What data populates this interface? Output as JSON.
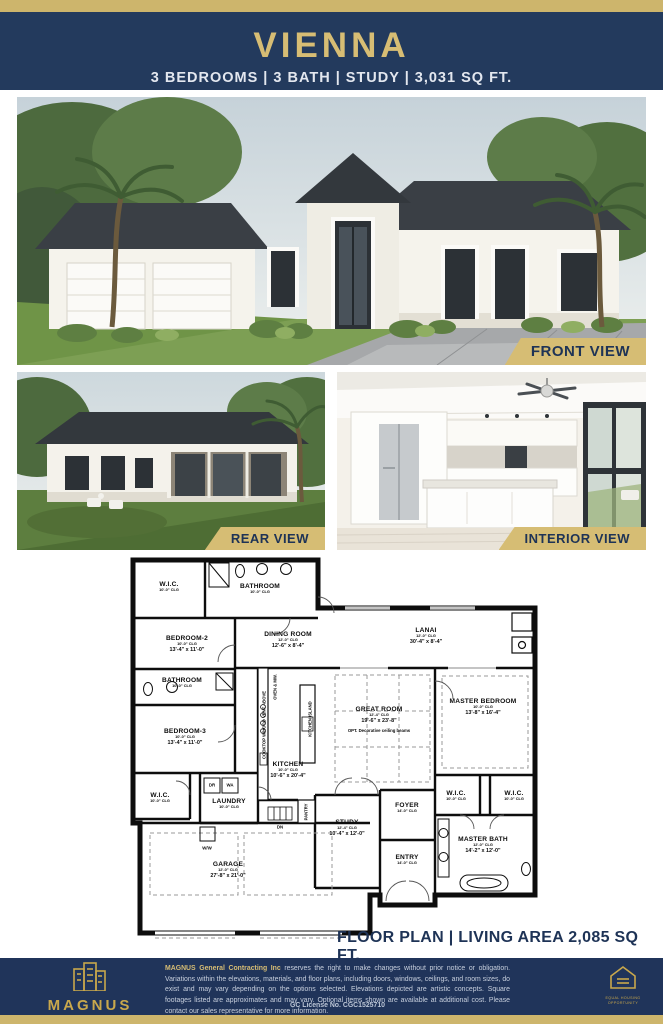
{
  "colors": {
    "gold": "#cdb56c",
    "banner_gold": "#d6bd74",
    "navy": "#233a5d",
    "footer_navy": "#20345a",
    "text_navy": "#1e3356"
  },
  "header": {
    "title": "VIENNA",
    "subtitle": "3 BEDROOMS | 3 BATH | STUDY | 3,031 SQ FT."
  },
  "views": {
    "front_label": "FRONT VIEW",
    "rear_label": "REAR VIEW",
    "interior_label": "INTERIOR VIEW"
  },
  "floor_plan": {
    "caption": "FLOOR PLAN  |  LIVING AREA 2,085 SQ FT.",
    "rooms": [
      {
        "name": "W.I.C.",
        "clg": "10'-0\" CLG",
        "x": 39,
        "y": 30
      },
      {
        "name": "BATHROOM",
        "clg": "10'-0\" CLG",
        "x": 130,
        "y": 32
      },
      {
        "name": "BEDROOM-2",
        "clg": "10'-0\" CLG",
        "dims": "13'-4\" x 11'-0\"",
        "x": 57,
        "y": 87
      },
      {
        "name": "DINING ROOM",
        "clg": "12'-0\" CLG",
        "dims": "12'-6\" x 8'-4\"",
        "x": 158,
        "y": 83
      },
      {
        "name": "LANAI",
        "clg": "12'-0\" CLG",
        "dims": "30'-4\" x 8'-4\"",
        "x": 296,
        "y": 79
      },
      {
        "name": "BATHROOM",
        "clg": "10'-0\" CLG",
        "x": 52,
        "y": 126
      },
      {
        "name": "BEDROOM-3",
        "clg": "10'-0\" CLG",
        "dims": "13'-4\" x 11'-0\"",
        "x": 55,
        "y": 180
      },
      {
        "name": "W.I.C.",
        "clg": "10'-0\" CLG",
        "x": 30,
        "y": 241
      },
      {
        "name": "LAUNDRY",
        "clg": "10'-0\" CLG",
        "x": 99,
        "y": 247
      },
      {
        "name": "KITCHEN",
        "clg": "10'-0\" CLG",
        "dims": "10'-6\" x 20'-4\"",
        "x": 158,
        "y": 213
      },
      {
        "name": "GREAT ROOM",
        "clg": "12'-4\" CLG",
        "dims": "19'-6\" x 23'-8\"",
        "note": "OPT. Decorative ceiling beams",
        "x": 249,
        "y": 163
      },
      {
        "name": "MASTER BEDROOM",
        "clg": "10'-0\" CLG",
        "dims": "13'-8\" x 16'-4\"",
        "x": 353,
        "y": 150
      },
      {
        "name": "W.I.C.",
        "clg": "10'-0\" CLG",
        "x": 326,
        "y": 239
      },
      {
        "name": "W.I.C.",
        "clg": "10'-0\" CLG",
        "x": 384,
        "y": 239
      },
      {
        "name": "FOYER",
        "clg": "14'-0\" CLG",
        "x": 277,
        "y": 251
      },
      {
        "name": "STUDY",
        "clg": "12'-4\" CLG",
        "dims": "10'-4\" x 12'-0\"",
        "x": 217,
        "y": 271
      },
      {
        "name": "ENTRY",
        "clg": "14'-0\" CLG",
        "x": 277,
        "y": 303
      },
      {
        "name": "MASTER BATH",
        "clg": "12'-0\" CLG",
        "dims": "14'-2\" x 12'-0\"",
        "x": 353,
        "y": 288
      },
      {
        "name": "GARAGE",
        "clg": "12'-0\" CLG",
        "dims": "27'-8\" x 21'-0\"",
        "x": 98,
        "y": 313
      }
    ],
    "vertical_labels": [
      {
        "text": "OVEN & MW.",
        "x": 145,
        "y": 130
      },
      {
        "text": "COOKTOP W/HOOD VENT ABOVE",
        "x": 134,
        "y": 168
      },
      {
        "text": "KITCHEN ISLAND",
        "x": 180,
        "y": 162
      },
      {
        "text": "PANTRY",
        "x": 176,
        "y": 255
      }
    ],
    "small_labels": [
      {
        "text": "DR",
        "x": 82,
        "y": 228
      },
      {
        "text": "WA",
        "x": 100,
        "y": 228
      },
      {
        "text": "DN",
        "x": 150,
        "y": 270
      },
      {
        "text": "W/W",
        "x": 77,
        "y": 291
      }
    ]
  },
  "footer": {
    "brand": "MAGNUS",
    "brand_sub": "GENERAL CONTRACTING INC",
    "disclaimer_lead": "MAGNUS General Contracting Inc",
    "disclaimer_body": " reserves the right to make changes without prior notice or obligation.  Variations within the elevations, materials, and floor plans, including doors, windows, ceilings, and room sizes, do exist and may vary depending on the options selected.  Elevations depicted are artistic concepts.  Square footages listed are approximates and may vary.  Optional items shown are available at additional cost.  Please contact our sales representative for more information.",
    "license": "GC License No. CGC1525710",
    "equal_housing": "EQUAL HOUSING\nOPPORTUNITY"
  }
}
